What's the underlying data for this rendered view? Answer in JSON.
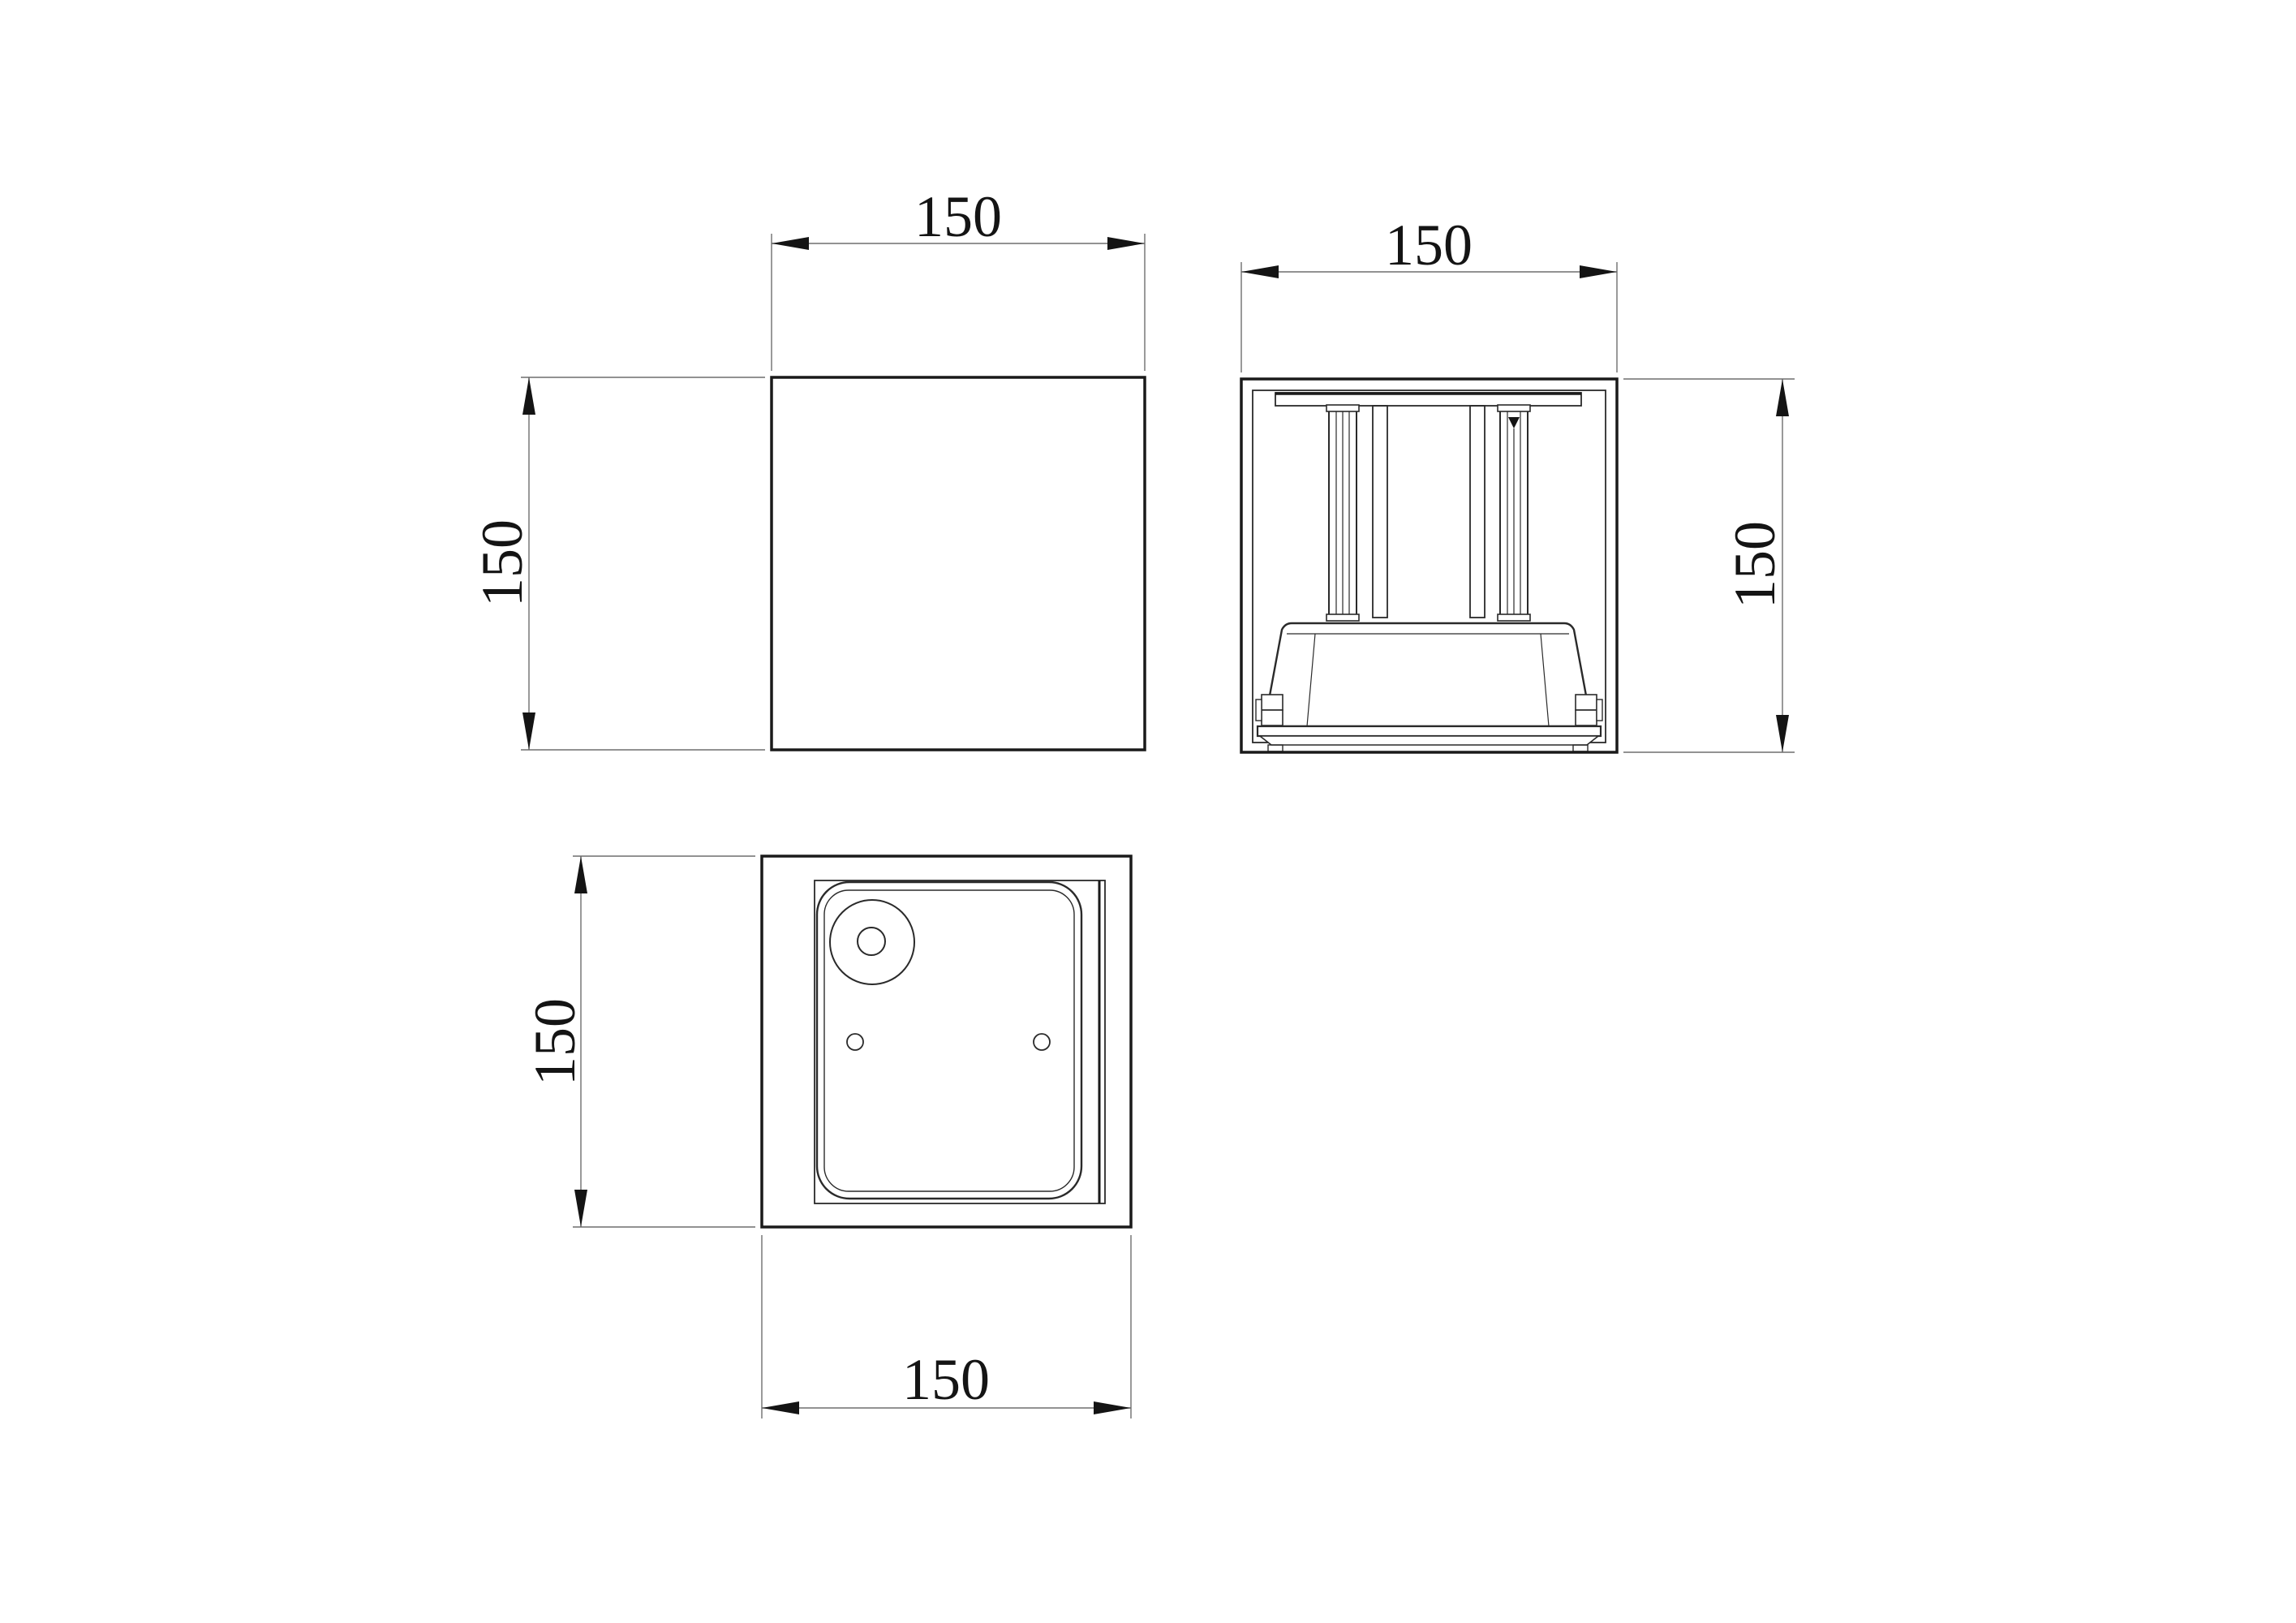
{
  "drawing": {
    "kind": "three_view_engineering_drawing",
    "background_color": "#ffffff",
    "outline_color": "#1a1a1a",
    "detail_line_color": "#2a2a2a",
    "dim_line_color": "#6e6e6e",
    "dim_text_color": "#141414",
    "dimensions": {
      "front_width": "150",
      "front_height": "150",
      "side_width": "150",
      "side_height": "150",
      "bottom_height": "150",
      "bottom_width": "150"
    }
  }
}
